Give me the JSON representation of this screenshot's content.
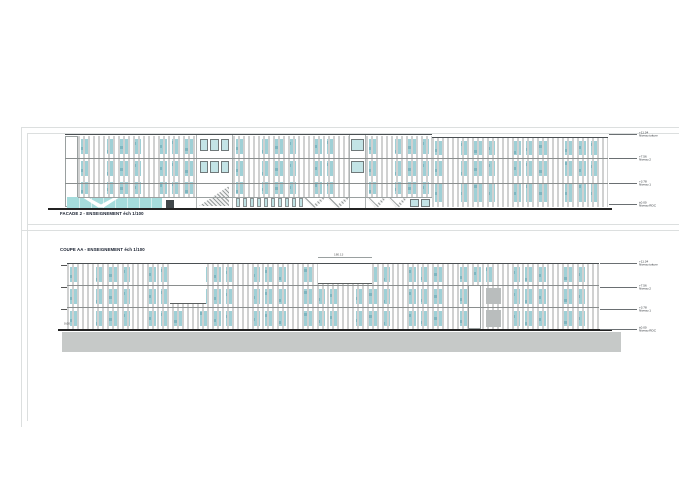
{
  "sheet": {
    "background": "#ffffff"
  },
  "colors": {
    "glazing": "#a5dcdc",
    "glazing_patch": "#9fd0d6",
    "glazing_speck": "#7db6c0",
    "slat": "#d0d1d1",
    "slab_line": "#8a8e8e",
    "outline": "#5c6060",
    "roof_line": "#4a4f52",
    "ground_line": "#232323",
    "ground_fill": "#c6c9c8",
    "concrete": "#b9bdbd",
    "frame_line": "#dcdfdf",
    "label_text": "#101828",
    "annotation_text": "#2c3136"
  },
  "drawings": [
    {
      "id": "facade-2",
      "title": "FACADE 2 - ENSEIGNEMENT éch 1/100",
      "levels": [
        {
          "value": "+11.34",
          "name": "Niveau toiture"
        },
        {
          "value": "+7.56",
          "name": "Niveau 2"
        },
        {
          "value": "+3.78",
          "name": "Niveau 1"
        },
        {
          "value": "±0.00",
          "name": "Niveau RDC"
        }
      ]
    },
    {
      "id": "coupe-aa",
      "title": "COUPE AA - ENSEIGNEMENT éch 1/100",
      "top_dimension": "180.13",
      "ground_level_label": "0.00",
      "levels": [
        {
          "value": "+11.34",
          "name": "Niveau toiture"
        },
        {
          "value": "+7.56",
          "name": "Niveau 2"
        },
        {
          "value": "+3.78",
          "name": "Niveau 1"
        },
        {
          "value": "±0.00",
          "name": "Niveau RDC"
        }
      ]
    }
  ]
}
